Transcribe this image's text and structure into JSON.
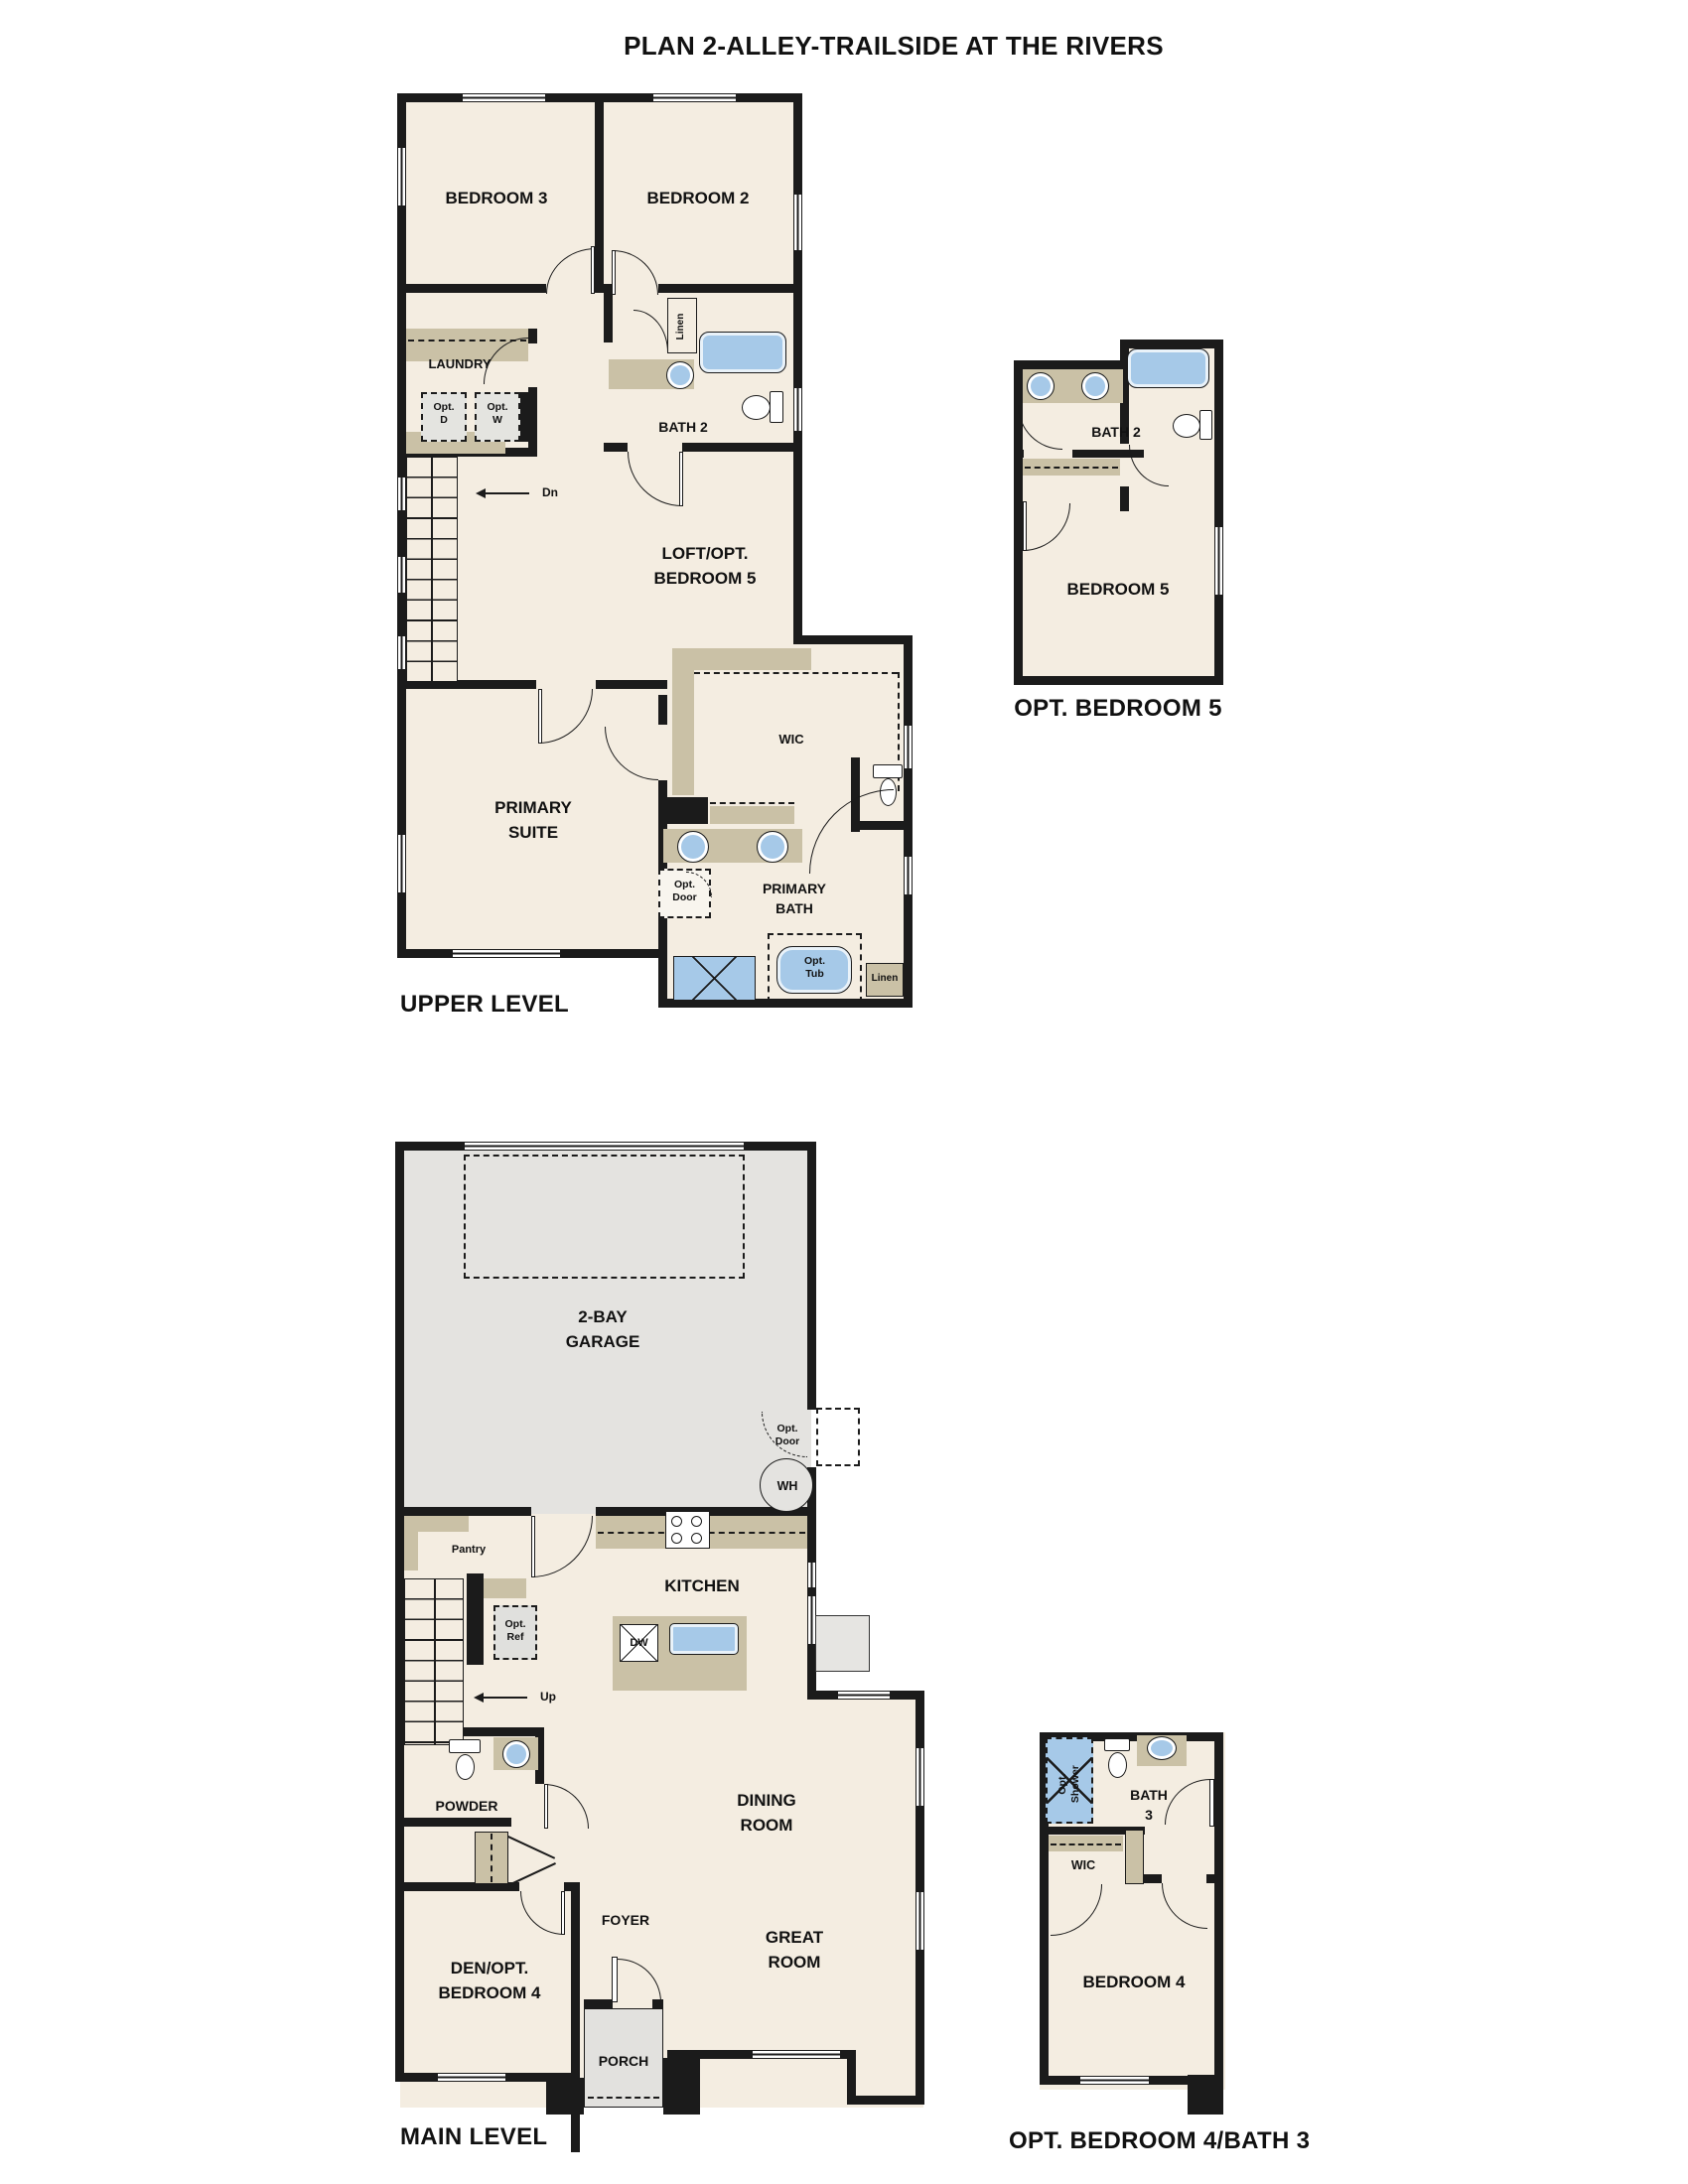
{
  "title": "PLAN 2-ALLEY-TRAILSIDE AT THE RIVERS",
  "colors": {
    "wall": "#1b1b1b",
    "room_fill": "#f4ede1",
    "garage_fill": "#e4e3e0",
    "cabinet_tan": "#cac1a6",
    "fixture_blue": "#a6c9e8"
  },
  "upper_level": {
    "caption": "UPPER LEVEL",
    "labels": {
      "bedroom3": "BEDROOM 3",
      "bedroom2": "BEDROOM 2",
      "laundry": "LAUNDRY",
      "opt_d": "Opt.\nD",
      "opt_w": "Opt.\nW",
      "linen": "Linen",
      "bath2": "BATH 2",
      "dn": "Dn",
      "loft": "LOFT/OPT.\nBEDROOM 5",
      "primary_suite": "PRIMARY\nSUITE",
      "wic": "WIC",
      "opt_door": "Opt.\nDoor",
      "primary_bath": "PRIMARY\nBATH",
      "opt_tub": "Opt.\nTub",
      "linen2": "Linen"
    }
  },
  "opt_bedroom5": {
    "caption": "OPT. BEDROOM 5",
    "labels": {
      "bath2": "BATH 2",
      "bedroom5": "BEDROOM 5"
    }
  },
  "main_level": {
    "caption": "MAIN LEVEL",
    "labels": {
      "garage": "2-BAY\nGARAGE",
      "opt_door": "Opt.\nDoor",
      "wh": "WH",
      "pantry": "Pantry",
      "kitchen": "KITCHEN",
      "dw": "DW",
      "opt_ref": "Opt.\nRef",
      "up": "Up",
      "powder": "POWDER",
      "dining": "DINING\nROOM",
      "foyer": "FOYER",
      "great_room": "GREAT\nROOM",
      "den": "DEN/OPT.\nBEDROOM 4",
      "porch": "PORCH"
    }
  },
  "opt_bedroom4_bath3": {
    "caption": "OPT. BEDROOM 4/BATH 3",
    "labels": {
      "opt_shower": "Opt.\nShower",
      "bath3": "BATH\n3",
      "wic": "WIC",
      "bedroom4": "BEDROOM 4"
    }
  }
}
